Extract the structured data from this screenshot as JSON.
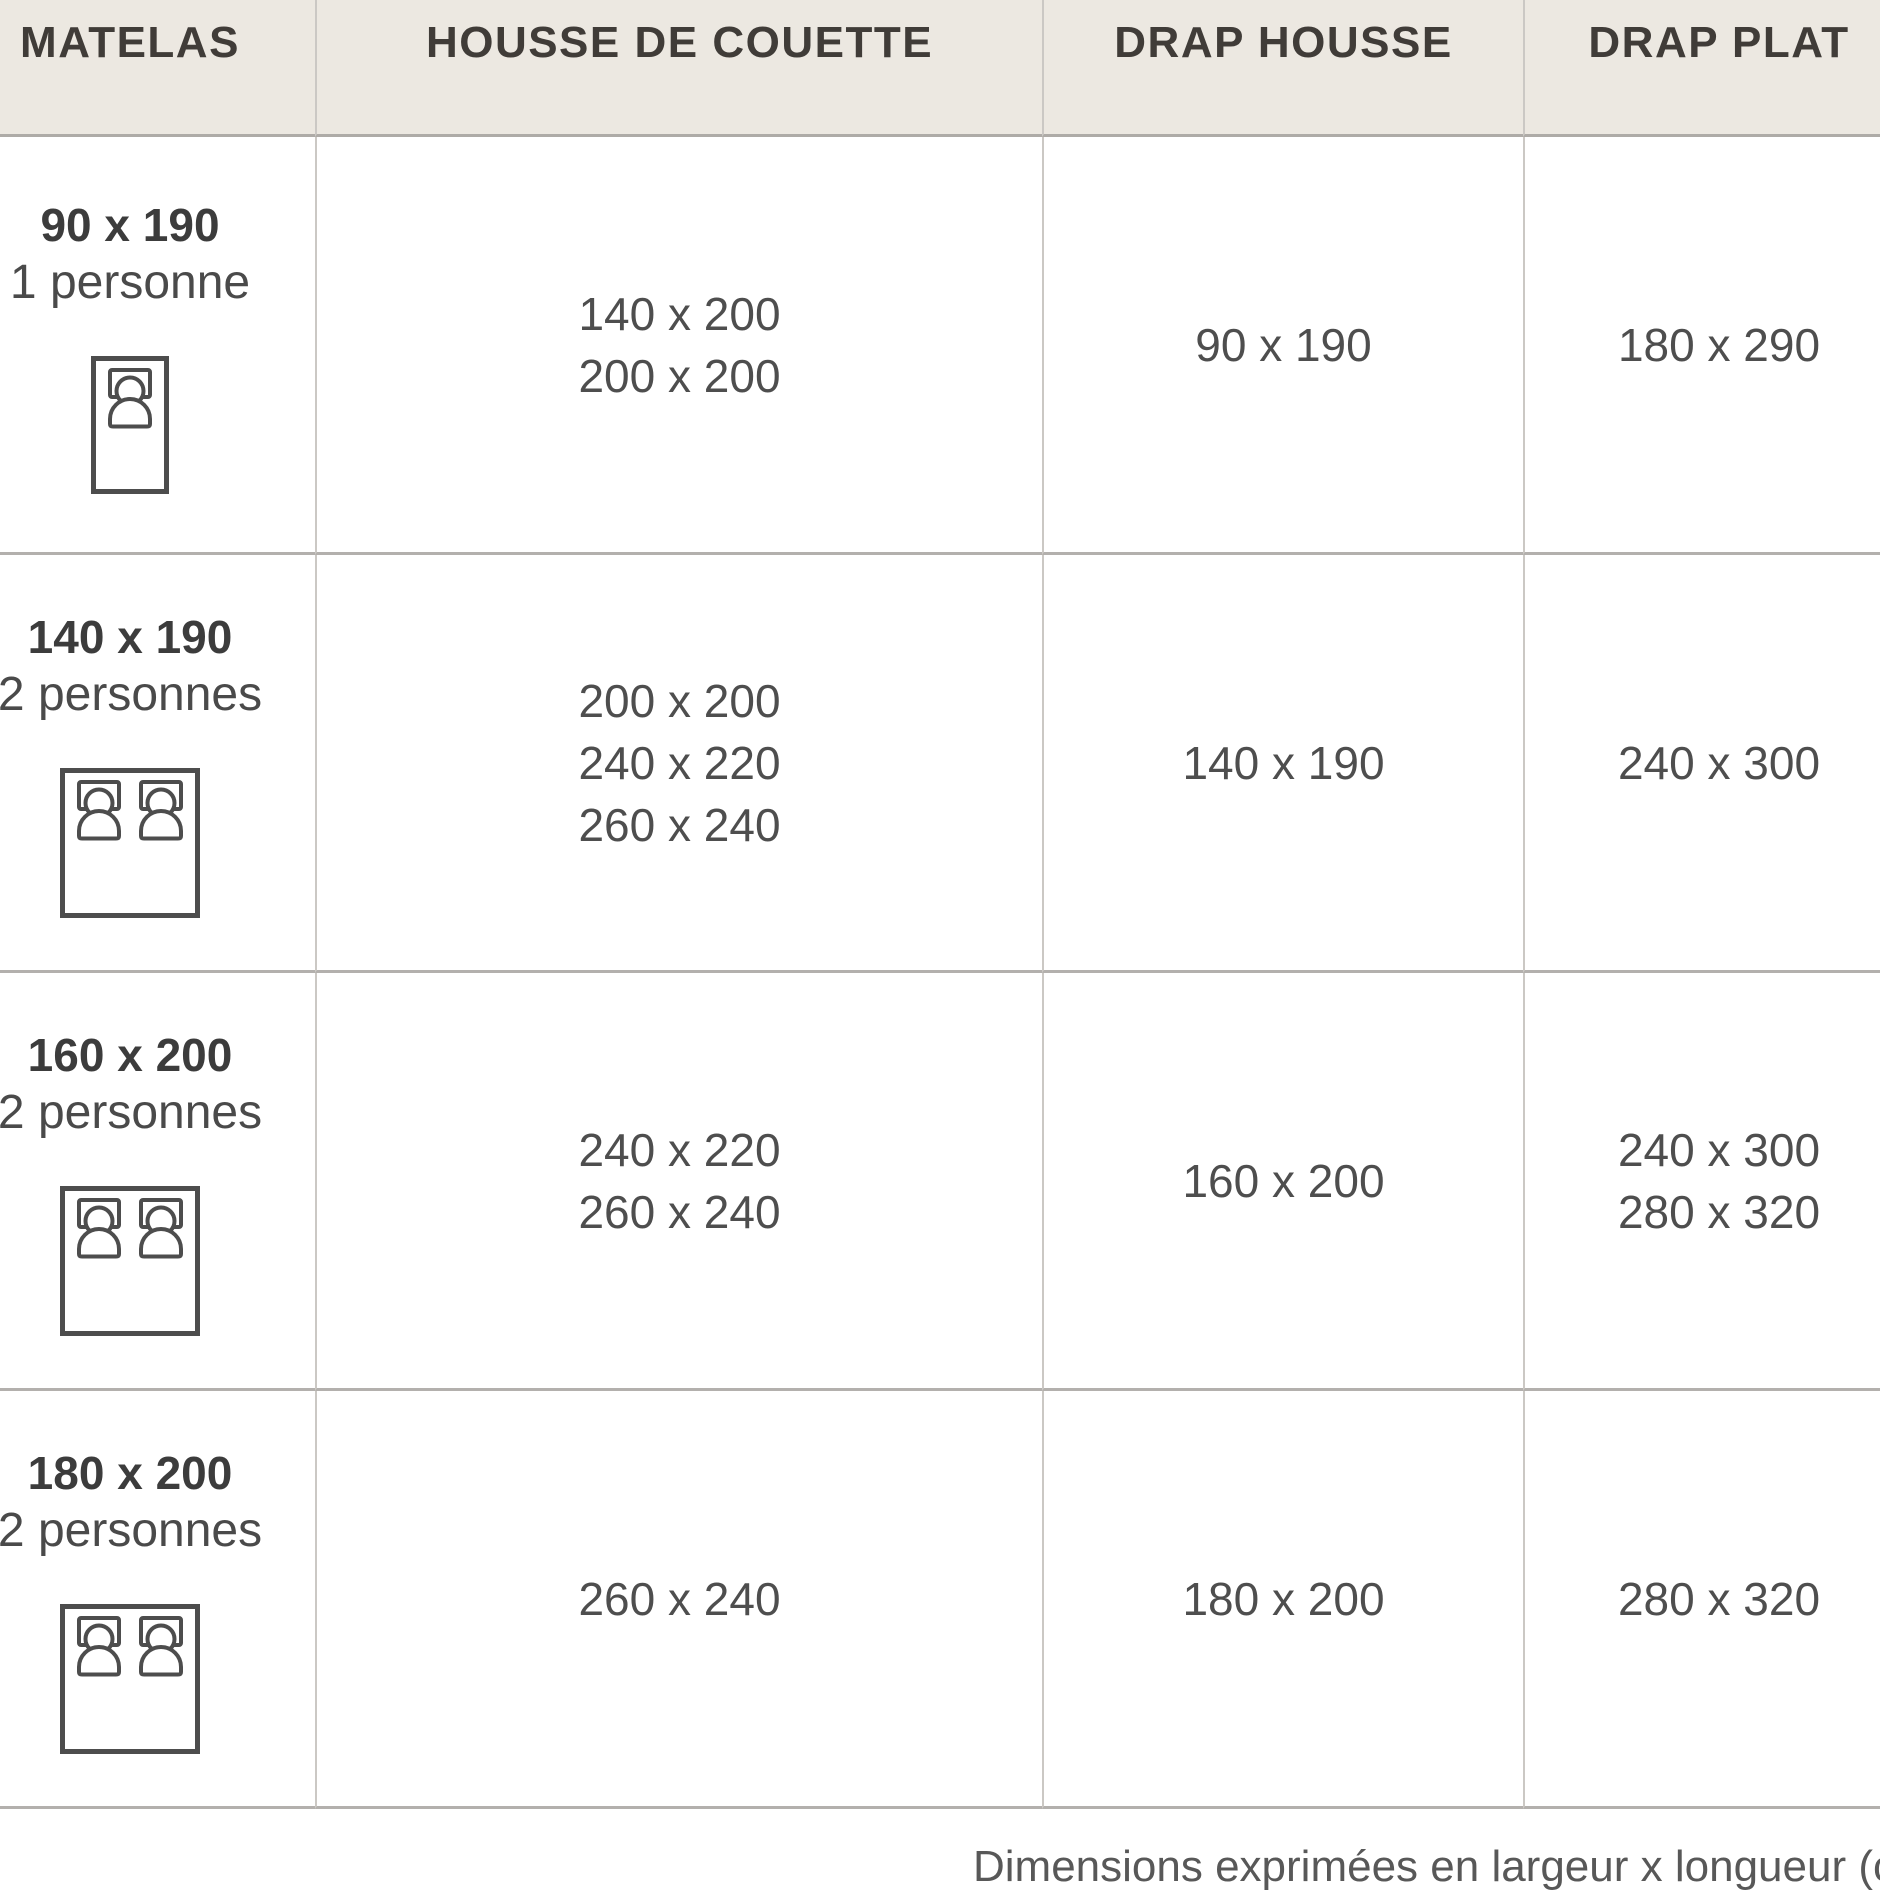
{
  "table": {
    "columns": [
      {
        "id": "matelas",
        "label": "MATELAS"
      },
      {
        "id": "housse_de_couette",
        "label": "HOUSSE DE COUETTE"
      },
      {
        "id": "drap_housse",
        "label": "DRAP HOUSSE"
      },
      {
        "id": "drap_plat",
        "label": "DRAP PLAT"
      }
    ],
    "rows": [
      {
        "mattress_size": "90 x 190",
        "capacity": "1 personne",
        "bed_icon": "single-bed",
        "housse_de_couette": [
          "140 x 200",
          "200 x 200"
        ],
        "drap_housse": [
          "90 x 190"
        ],
        "drap_plat": [
          "180 x 290"
        ]
      },
      {
        "mattress_size": "140 x 190",
        "capacity": "2 personnes",
        "bed_icon": "double-bed",
        "housse_de_couette": [
          "200 x 200",
          "240 x 220",
          "260 x 240"
        ],
        "drap_housse": [
          "140 x 190"
        ],
        "drap_plat": [
          "240 x 300"
        ]
      },
      {
        "mattress_size": "160 x 200",
        "capacity": "2 personnes",
        "bed_icon": "double-bed",
        "housse_de_couette": [
          "240 x 220",
          "260 x 240"
        ],
        "drap_housse": [
          "160 x 200"
        ],
        "drap_plat": [
          "240 x 300",
          "280 x 320"
        ]
      },
      {
        "mattress_size": "180 x 200",
        "capacity": "2 personnes",
        "bed_icon": "double-bed",
        "housse_de_couette": [
          "260 x 240"
        ],
        "drap_housse": [
          "180 x 200"
        ],
        "drap_plat": [
          "280 x 320"
        ]
      }
    ]
  },
  "footnote": "Dimensions exprimées en largeur x longueur (cm)",
  "colors": {
    "header_bg": "#ece8e1",
    "vertical_line": "#cbc8c4",
    "horizontal_line": "#b3b0ad",
    "text": "#4e4e4e",
    "icon_stroke": "#4d4d4d"
  }
}
